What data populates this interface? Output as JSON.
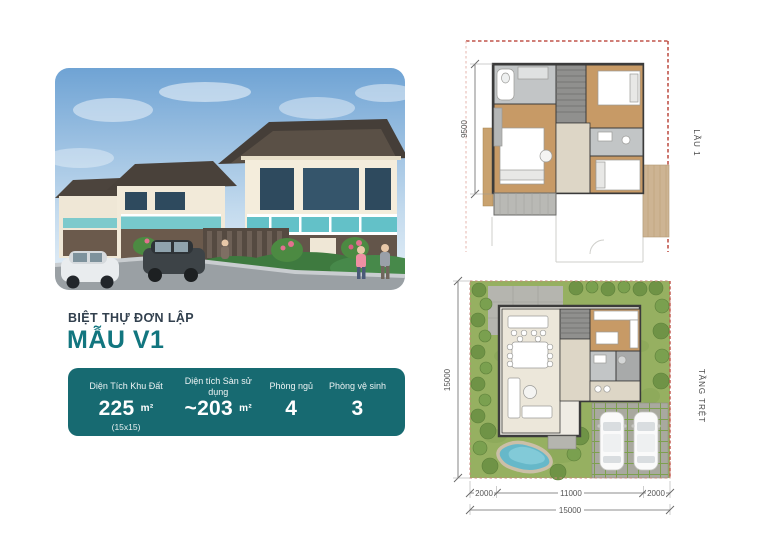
{
  "listing": {
    "category": "BIỆT THỰ ĐƠN LẬP",
    "model": "MẪU V1"
  },
  "specs": {
    "accent_color": "#176a71",
    "items": [
      {
        "label": "Diện Tích Khu Đất",
        "value": "225",
        "unit": "m²",
        "note": "(15x15)"
      },
      {
        "label": "Diện tích Sàn sử dụng",
        "value": "~203",
        "unit": "m²"
      },
      {
        "label": "Phòng ngủ",
        "value": "4"
      },
      {
        "label": "Phòng vệ sinh",
        "value": "3"
      }
    ]
  },
  "plans": {
    "upper": {
      "label": "LẦU 1",
      "dim_left": "9500"
    },
    "lower": {
      "label": "TẦNG TRỆT",
      "dim_left": "15000",
      "dim_bottom_left": "2000",
      "dim_bottom_mid": "11000",
      "dim_bottom_right": "2000",
      "dim_bottom_total": "15000"
    }
  },
  "colors": {
    "title_dark": "#32404e",
    "model_teal": "#12767f",
    "card_teal": "#176a71",
    "boundary_red": "#c0544a",
    "wood_floor": "#c79a66",
    "grass_green": "#96b061"
  }
}
